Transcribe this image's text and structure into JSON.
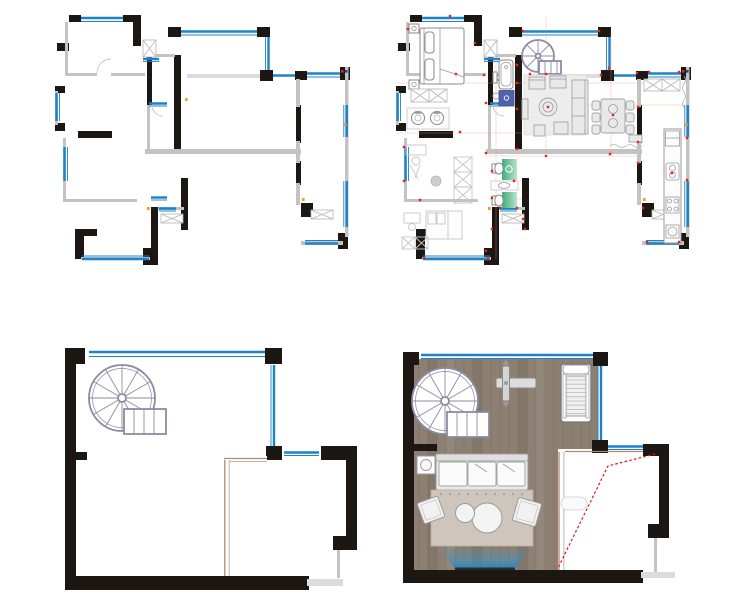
{
  "sheet": {
    "kind": "residential floor plan sheet",
    "background": "#ffffff",
    "plans": [
      {
        "id": "main-floor-structural",
        "position": "top-left",
        "style": "walls-only",
        "features": [
          "black-structural-walls",
          "gray-partition-walls",
          "blue-window-lines",
          "door-openings",
          "closet-hatch-symbols",
          "orange-markers"
        ]
      },
      {
        "id": "main-floor-furnished",
        "position": "top-right",
        "style": "furnished",
        "rooms": [
          "master-bedroom",
          "bathroom",
          "spiral-stair-hall",
          "living-room",
          "dining-room",
          "kitchen",
          "pantry",
          "laundry",
          "study",
          "upper-small-bathroom",
          "lower-small-bathroom",
          "second-bedroom"
        ],
        "symbols": [
          "bed",
          "bathtub",
          "toilet",
          "shower",
          "spiral-staircase",
          "sofa-set",
          "dining-table-with-chairs",
          "kitchen-counter",
          "washing-machines",
          "wardrobes",
          "red-electrical-dots",
          "red-alignment-lines",
          "green-bath-floors"
        ]
      },
      {
        "id": "loft-structural",
        "position": "bottom-left",
        "style": "walls-only",
        "features": [
          "spiral-staircase",
          "partition-wall",
          "blue-window-lines",
          "black-structural-walls"
        ]
      },
      {
        "id": "loft-furnished",
        "position": "bottom-right",
        "style": "furnished",
        "symbols": [
          "wood-plank-floor",
          "spiral-staircase",
          "weight-bench",
          "treadmill",
          "sofa",
          "rug",
          "coffee-tables",
          "floor-cushions",
          "side-table",
          "projection-beam",
          "ottoman",
          "red-dashed-sightline"
        ]
      }
    ]
  },
  "colors": {
    "wall_black": "#1c1713",
    "wall_gray": "#c3c3c3",
    "wall_light": "#dcdcdc",
    "window_blue": "#1d83c9",
    "red_marker": "#e8231c",
    "red_dashed": "#e11616",
    "orange_marker": "#f59a23",
    "navy_marker": "#2a3f8f",
    "wood_floor": "#8d8073",
    "wood_grain": "#75695d",
    "green_floor": "#3fae79",
    "green_floor_light": "#b9e2cd",
    "shower_blue": "#5164a9",
    "stair_outline": "#8d8aa3",
    "sketch_gray": "#c6c6c6",
    "rug_fill": "#cec6bd",
    "beam_blue": "#1a82c6"
  }
}
